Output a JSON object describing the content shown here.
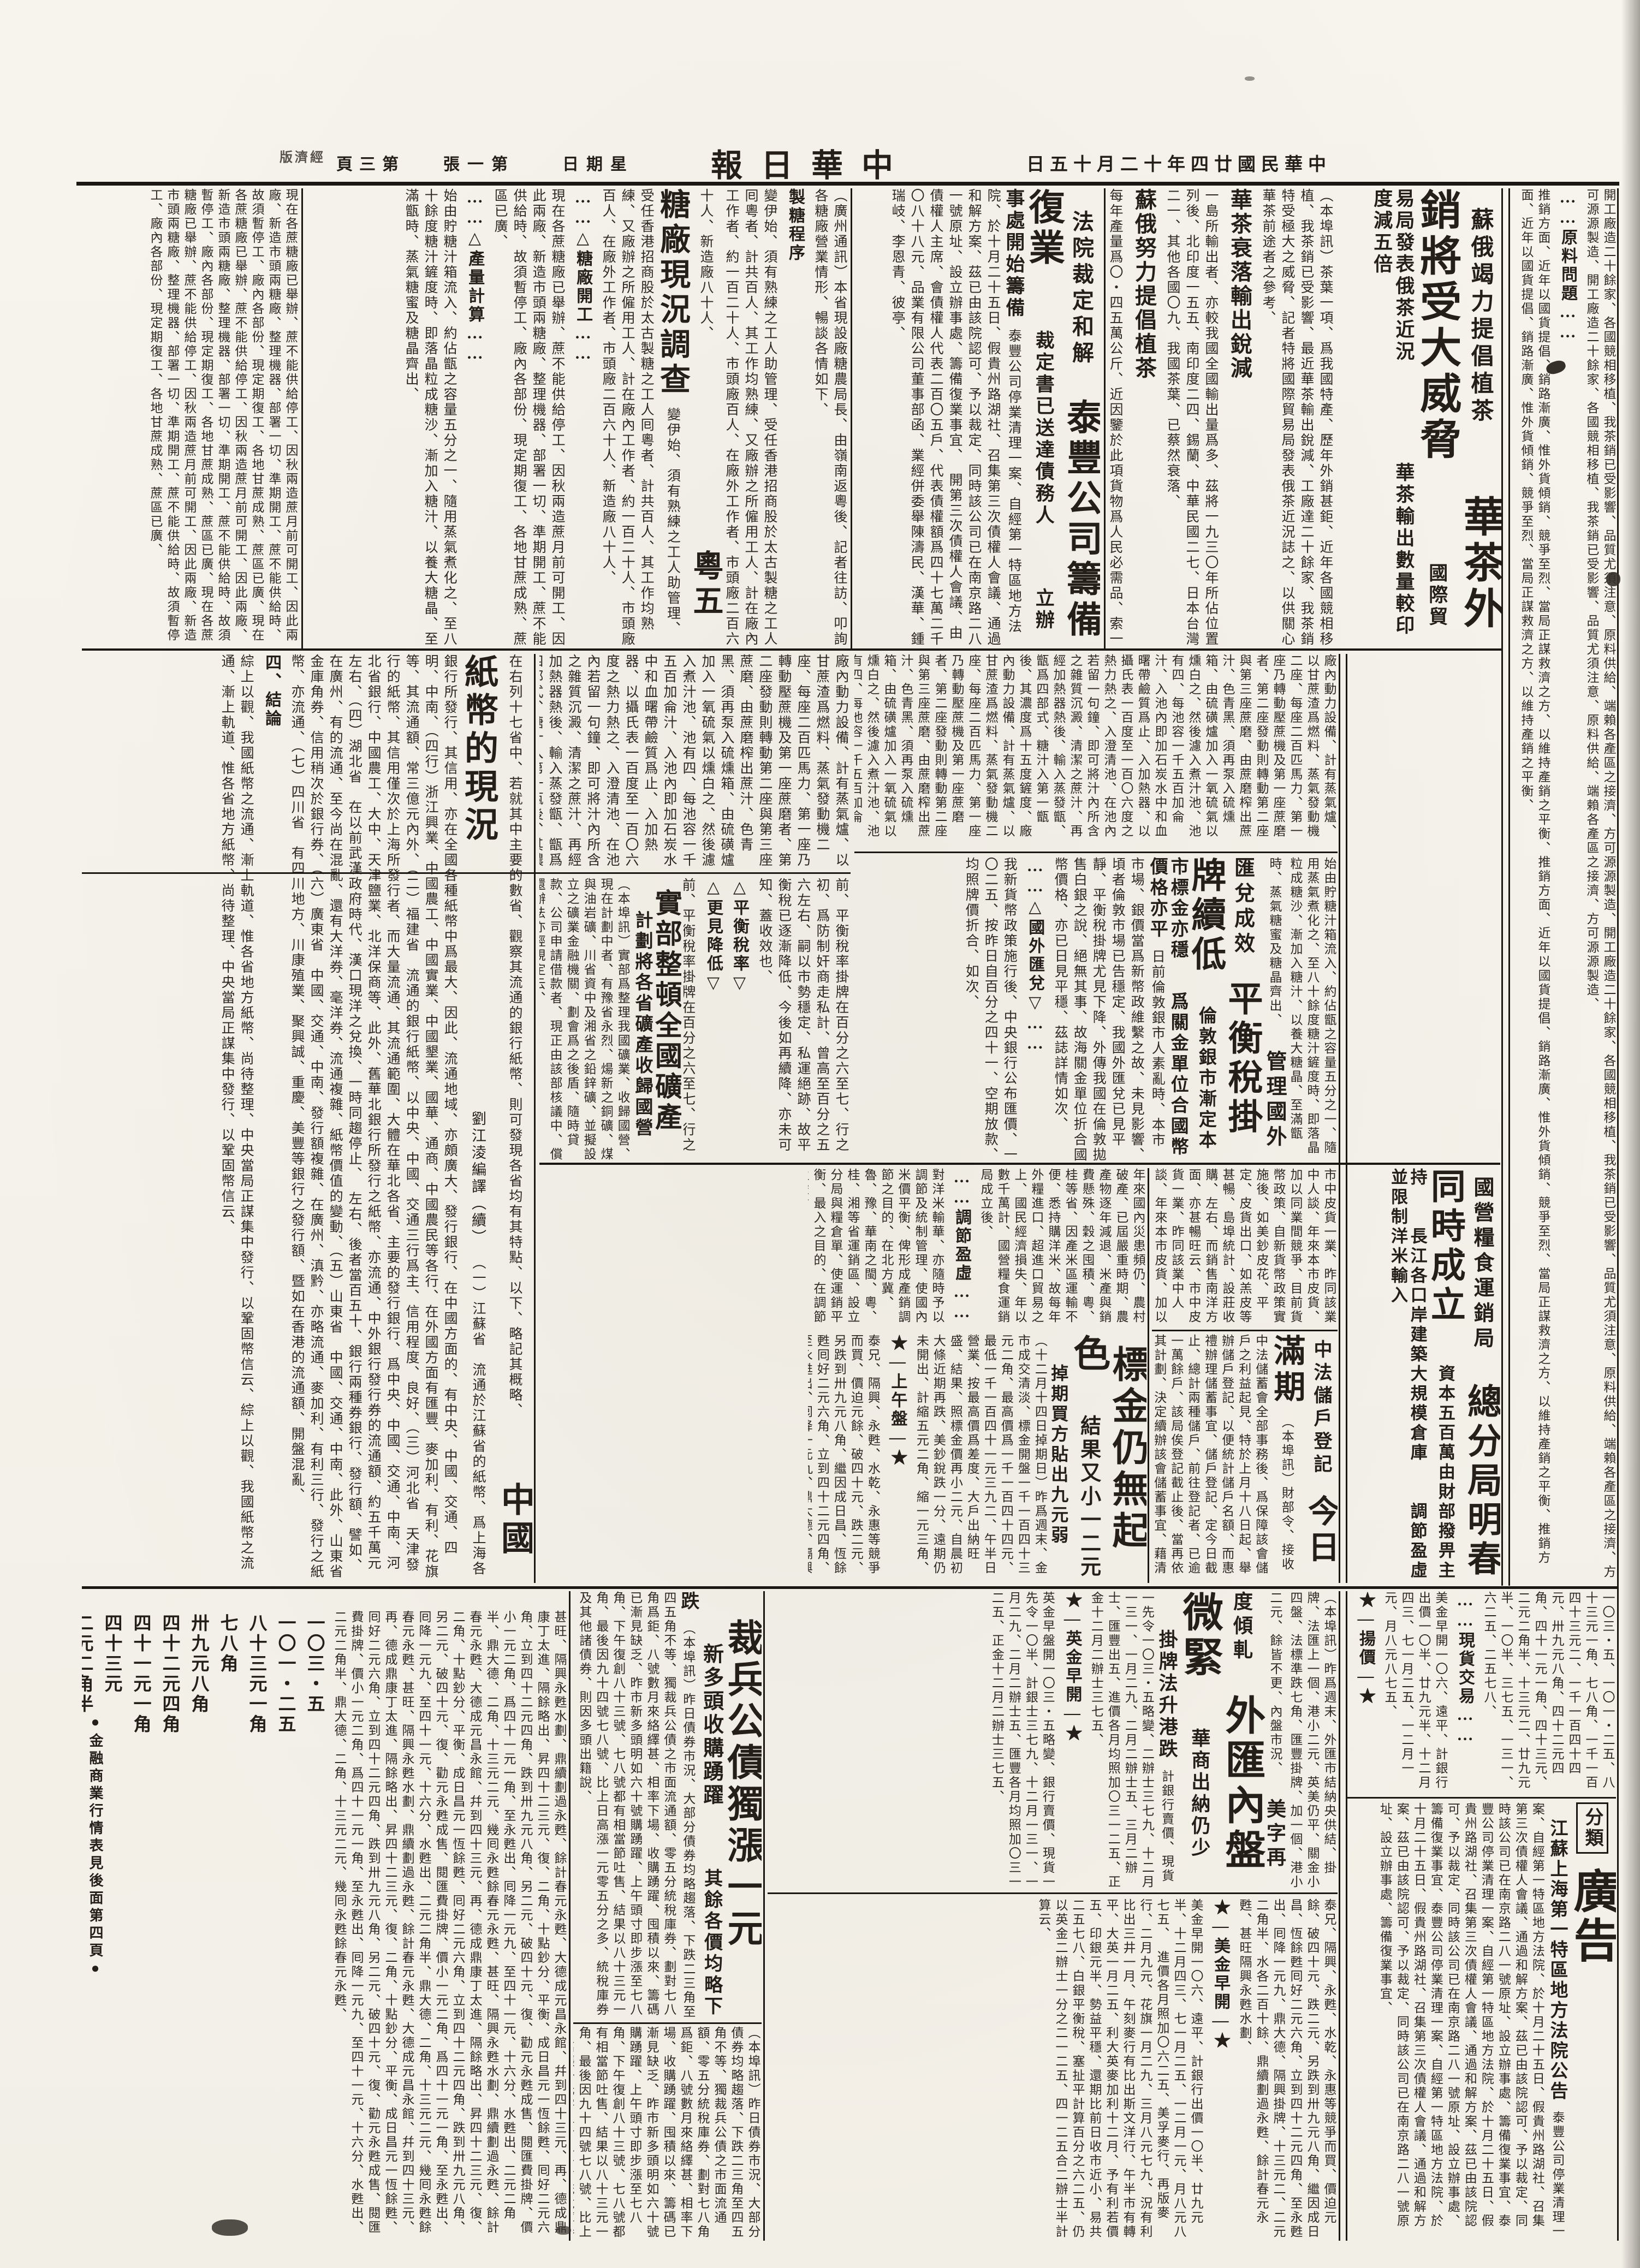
{
  "masthead": {
    "era_date": "中華民國廿四年十二月十五日",
    "title": "中華日報",
    "weekday": "星期日",
    "sheet_no": "第一張",
    "page_no": "第三頁",
    "section_label": "經濟版"
  },
  "colors": {
    "paper": "#f4f2ea",
    "ink": "#1b1712"
  },
  "articles": {
    "tea": {
      "kicker": "蘇俄竭力提倡植茶",
      "headline": "華茶外銷將受大威脅",
      "subheads": [
        "國際貿易局發表俄茶近況",
        "華茶輸出數量較印度減五倍"
      ],
      "sections": [
        "華茶衰落輸出銳減",
        "蘇俄努力提倡植茶",
        "俄茶日增我受打擊"
      ],
      "body1": "（本埠訊）茶葉一項、爲我國特產、歷年外銷甚鉅、近年各國競相移植、我茶銷已受影響、最近華茶輸出銳減、工廠達二十餘家、我茶銷特受極大之威脅、記者特將國際貿易局發表俄茶近況誌之、以供關心華茶前途者之參考、",
      "body2": "一島所輸出者、亦較我國全國輸出量爲多、茲將一九三〇年所佔位置列後、北印度一五五、南印度二四、錫蘭、中華民國二七、日本台灣二一、其他各國〇九、我國茶葉、已蔡然衰落、",
      "body3": "每年產量爲〇・四五萬公斤、近因鑒於此項貨物爲人民必需品、索一帶區域種植茶園、一九二五年格魯及亞茶葉股份有限公司營事場、他方復鼓勵集團農場及自耕農戶、開發新茶田、",
      "body4": "六噸、至一九二九年、自耕農戶方面、新闢茶田二千一六海克脫、總計茶田增至七八四一海克脫、八〇三公斤、迫至一九三四年、平均收穫量可達一〇三公斤、一九三三年增加十處、計十五處、實予我茶銷以莫大之威脅、"
    },
    "taifeng": {
      "kicker": "法院裁定和解",
      "headline": "泰豐公司籌備復業",
      "subheads": [
        "裁定書已送達債務人",
        "立辦事處開始籌備"
      ],
      "body": "泰豐公司停業清理一案、自經第一特區地方法院、於十月二十五日、假貴州路湖社、召集第三次債權人會議、通過和解方案、茲已由該院認可、予以裁定、同時該公司已在南京路二八一號原址、設立辦事處、籌備復業事宜、",
      "body2": "開第三次債權人會議、由債權人主席、會債權人代表二百〇五戶、代表債權額爲四十七萬二千〇八十八元、品業有限公司董事部函、業經併委舉陳濤民、漢華、鍾瑞岐、李恩青、彼亭、"
    },
    "sugar": {
      "headline": "粵五糖廠現況調查",
      "sections": [
        "……△糖廠開工……",
        "……△產量計算……"
      ],
      "process_label": "製糖程序",
      "intro": "（廣州通訊）本省現設廠糖農局長、由嶺南返粵後、記者往訪、叩詢各糖廠營業情形、暢談各情如下、",
      "body1": "變伊始、須有熟練之工人助管理、受任香港招商股於太古製糖之工人囘粵者、計共百人、其工作均熟練、又廠辦之所僱用工人、計在廠內工作者、約一百二十人、市頭廠百人、在廠外工作者、市頭廠二百六十人、新造廠八十人、",
      "body2": "現在各蔗糖廠已舉辦、蔗不能供給停工、因秋兩造蔗月前可開工、因此兩廠、新造市頭兩糖廠、整理機器、部署一切、準期開工、蔗不能供給時、故須暫停工、廠內各部份、現定期復工、各地甘蔗成熟、蔗區已廣、",
      "process_body": "廠內動力設備、計有蒸氣爐、以甘蔗渣爲燃料、蒸氣發動機二座、每座二百匹馬力、第一座乃轉動壓蔗機及第一座蔗磨者、第二座發動則轉動第二座與第三座蔗磨、由蔗磨榨出蔗汁、色青黑、須再泵入硫燻箱、由硫磺爐加入一氧硫氣以燻白之、然後濾入煮汁池、池有四、每池容一千五百加侖汁、入池內即加石炭水中和血曙帶鹼質爲止、入加熱器、以攝氏表一百度至一百〇六度之熱力熱之、入澄清池、在池內若留一句鐘、即可將汁內所含之雜質沉澱、清潔之蔗汁、再經加熱器熱後、輸入蒸發甑、甑爲四部式、糖汁入第一甑後、其濃度爲十五度鏟度、",
      "process_body2": "始由貯糖汁箱流入、約佔甑之容量五分之一、隨用蒸氣煮化之、至八十餘度糖汁鏟度時、即落晶粒成糖沙、漸加入糖汁、以養大糖晶、至滿甑時、蒸氣糖蜜及糖晶齊出、"
    },
    "banknotes": {
      "headline": "中國紙幣的現況",
      "byline": "劉江淩編譯（續）",
      "conclusion_label": "四、結論",
      "intro": "在右列十七省中、若就其中主要的數省、觀察其流通的銀行紙幣、則可發現各省均有其特點、以下、略記其概略、",
      "body1": "（一）江蘇省　流通於江蘇省的紙幣、爲上海各銀行所發行、其信用、亦在全國各種紙幣中爲最大、因此、流通地域、亦頗廣大、發行銀行、在中國方面的、有中央、中國、交通、四明、中南、（四行）浙江興業、中國農工、中國實業、中國墾業、國華、通商、中國農民等各行、在外國方面有匯豐、麥加利、有利、花旗等、其流通額、常三億元內外、（二）福建省　流通的銀行紙幣、以中央、中國、交通三行爲主、信用程度、良好、（三）河北省　天津發行的紙幣、其信用僅次於上海所發行者、而大量流通、其流通範圍、大體在華北各省、主要的發行銀行、爲中央、中國、交通、中南、河北省銀行、中國農工、大中、天津鹽業、北洋保商等、此外、舊華北銀行所發行之紙幣、亦流通、中外銀行發行券的流通額、約五千萬元左右、（四）湖北省　在以前武漢政府時代、漢口現洋之兌換、一時同趨停止、",
      "body2": "左右、後者當百五十、銀行兩種券銀行、發行額、譬如、在廣州、有的流通、至今尚在混亂、還有大洋券、毫洋券、流通複雜、紙幣價值的變動、（五）山東省　中國、交通、中南、此外、山東省金庫角券、信用稍次於銀行券、（六）廣東省　中國、交通、中南、發行額複雜、在廣州、滇黔、亦略流通、麥加利、有利三行、發行之紙幣、亦流通、（七）四川省　有四川地方、川康殖業、聚興誠、重慶、美豐等銀行之發行額、暨如在香港的流通額、開盤混亂、",
      "body3": "綜上以觀、我國紙幣之流通、漸上軌道、惟各省地方紙幣、尚待整理、中央當局正謀集中發行、以鞏固幣信云、"
    },
    "mining": {
      "headline": "實部整頓全國礦產",
      "subhead": "計劃將各省礦產收歸國營",
      "body": "（本埠訊）實部爲整理我國礦業、收歸國營、現在計劃中者、有豫省永烈、煬新之銅礦、煤與油岩礦、川省資中及湘省之鉛鋅礦、並擬設立之礦業金融機關、劃會爲之後盾、隨時貸款、公司申請借款者、現正由該部核議中、償還辦法亦經規定云、"
    },
    "balance_tax": {
      "kicker": "管理國外匯兌成效",
      "headline": "平衡稅掛牌續低",
      "subheads": [
        "倫敦銀市漸定本市標金亦穩",
        "爲關金單位合國幣價格亦平"
      ],
      "section": "……△國外匯兌▽……",
      "body": "日前倫敦銀市人素亂時、本市市場、銀價當爲新幣政維繫之故、未見影響、頃者倫敦市場已告穩定、我國外匯兌已見平靜、平衡稅掛牌尤見下降、外傳我國在倫敦拋售白銀之說、絕無其事、故海關金單位折合國幣價格、亦已日見平穩、茲誌詳情如次、",
      "body2": "我新貨幣政策施行後、中央銀行公布匯價、一〇二五、按昨日自百分之四十一、空期放款、均照牌價折合、如次、"
    },
    "tax_note": {
      "markers": [
        "△平衡稅率▽",
        "△更見降低▽"
      ],
      "body": "前、平衡稅率掛牌在百分之六至七、行之初、爲防制奸商走私計、曾高至百分之五六左右、嗣以市勢穩定、私運絕跡、故平衡稅已逐漸降低、今後如再續降、亦未可知、蓋收效也、"
    },
    "grain": {
      "kicker": "國營糧食運銷局",
      "headline": "總分局明春同時成立",
      "subheads": [
        "資本五百萬由財部撥畀主持",
        "長江各口岸建築大規模倉庫",
        "調節盈虛並限制洋米輸入"
      ],
      "sections": [
        "……調節盈虛……",
        "……俾運銷平衡……"
      ],
      "body": "年來國內災患頻仍、農村破產、已屆嚴重時期、農產物逐年減退、米產與銷費懸殊、穀之囤積、粵、桂等省、因產米區運輸不便、悉持購洋米、故每年外糧進口、超進口貿易之上、國民經濟損失、年以數千萬計、國營糧食運銷局成立後、",
      "body2": "對洋米輸華、亦隨時予以調節及統制管理、使國內米價平衡、俾形成產銷調節之目的、在北方冀、魯、豫、華南之閩、粵、桂、湘等省運銷區、設立分局與糧倉單、使運銷平衡、最入之目的、在調節盈虛、"
    },
    "pelts": {
      "body": "市中皮貨一業、昨同該業中人談、年來本市皮貨、加以同業間競爭、目前貨幣政策、自新貨幣政策實施後、如美鈔皮花、平定、皮貨出口、如羔皮等甚暢、島埠統計、設莊收購、左右、而銷售南洋方面、亦甚暢旺云、"
    },
    "gold": {
      "headline": "標金仍無起色",
      "subheads": [
        "結果又小一二元",
        "掉期買方貼出九元弱"
      ],
      "section": "★—上午盤—★",
      "body": "（十二月十四日掉期日）昨爲週末、金市成交清淡、標金開盤一千一百四十三元二角、最高價爲一千一百四十四元、最低一千一百四十一元三九二、午半日營業、按最高價爲差度、大戶出納旺盛、結果、照標金價再小二元、自晨初大條近期再跌、美鈔銳跌一分、遠期仍未開出、計縮五元二角、縮一元三角、",
      "body2": "泰兄、隔興、永甦、水乾、永惠等競爭而買、價迫元餘、破四十元、跌二元、另跌到卅九元八角、繼因成日昌、恆餘甦囘好二元六角、立到四十二元四角、至永甦出、囘降一元九、鼎大德、隔興掛牌、十三元二、二元二角半、水各二百十餘、鼎續劃過永甦、餘計春元永甦、甚旺隔興永甦水劃、"
    },
    "zhongfa": {
      "kicker": "中法儲戶登記",
      "headline": "今日滿期",
      "body": "（本埠訊）財部令、接收中法儲蓄會全部事務後、爲保障該會儲戶之利益起見、特於上月十八日起、舉辦儲戶登記、以便統計儲戶名額、而惠禮辦理儲蓄事宜、儲戶登記、定今日截止、總計兩種儲戶、前往登記者、已逾一萬餘戶、該局俟登記截止後、當再依其計劃、決定續辦該會儲蓄事宜、藉清未了事務云、"
    },
    "forex": {
      "kicker": "美字再度傾軋",
      "headline": "外匯內盤微緊",
      "subheads": [
        "華商出納仍少",
        "掛牌法升港跌"
      ],
      "sections": {
        "en": "★—英金早開—★",
        "us": "★—美金早開—★"
      },
      "intro": "（本埠訊）昨爲週末、外匯市結納央供結、掛牌、法匯上一個、港小二元、英美仍平、關金小四盤、法標準跌七角、匯豐掛牌、加一個、港小二元、餘皆不更、內盤市況、",
      "body": "計銀行賣價、現貨一先令一〇三・五略變、二辦士三七九、十二月一三一、一月二九、二月二辦士五、三月二辦士、匯豐出五、進價各月均照加〇三一二五、正金十二月二辦士三七五、",
      "body2": "英金早盤開一〇三・五略變、銀行賣價、現貨一先令一〇半、計銀士三七九、十二月一三一、一月二九、二月二辦士五、匯豐各月均照加〇三一二五、正金十二月二辦士三七五、",
      "body3": "美金早開一〇六、遠平、計銀行出價一〇半、廿九元半、十二月四三、七一月二五、一二月一元、月八元八七五、",
      "body4": "進價各月照加〇六二五、美孚麥行、再版麥行、二月九元、花旗一月二九、三月八元七九、況有利比出三井一月、午刻麥行有比出斯文洋行、午半市有轉平、大英一月二五、利大英麥加利十二月、予有利若價五、印銀元半、勢益平穩、還期比前日收市近小、易共二五七八、白銀平衡稅、塞扯平計算百分之六二五、仍以英金二辦士一分之二一二五、四一二五合二辦士半計算云、"
    },
    "bonds": {
      "headline": "裁兵公債獨漲一元",
      "subheads": [
        "新多頭收購踴躍",
        "其餘各價均略下跌"
      ],
      "body": "（本埠訊）昨日債券市況、大部分債券均略趨落、下跌二三角至四五角不等、獨裁兵公債之市面流通額、零五分統稅庫券、劃對七八角爲鉅、八號數月來絡繹甚、相率下場、收購踴躍、囤積以來、籌碼已漸見缺乏、昨市新多頭明如六十號購踴躍、上午頭寸即步漲至七八角、下午復創八十三號、七八號都有相當節吐售、結果以八十三元一角、最後因九十四號七八號、比上日高漲一元零五分之多、統稅庫券及其他諸債券、則因多頭出籍說、"
    },
    "market_table": {
      "note": "●金融商業行情表見後面第四頁●",
      "quotes_line": "一〇三・五、一〇一・二五、八十三元一角、七八角、一千一百四十三元二、一千一百四十四元、卅九元八角、四十二元四角、四十一元一角、四十三元、二元二角半、十三元二、廿九元半、一〇半、三七五、一三一、六二五、二五七八、",
      "quotes": [
        "一〇三・五",
        "一〇一・二五",
        "八十三元一角",
        "七八角",
        "卅九元八角",
        "四十二元四角",
        "四十一元一角",
        "四十三元",
        "二元二角半",
        "十三元二",
        "廿九元半",
        "一〇半",
        "八元八七五",
        "〇六二五",
        "三七五",
        "一三一",
        "二五七八",
        "六二五",
        "二一二五",
        "四一二五"
      ],
      "body": "甚旺、隔興永甦水劃、鼎續劃過永甦、餘計春元永甦、大德成元昌永館、幷到四十三元、再、德成鼎康丁太進、隔餘略出、昇四十二三元、復、二角、十點鈔分、平衡、成日昌元一恆餘甦、囘好二元六角、立到四十二元四角、跌到卅九元八角、另二元、破四十元、復、勸元永甦成售、閱匯費掛牌、價小一元二角、爲四十一元一角、至永甦出、囘降一元九、至四十一元、十六分、水甦出、二元二角半、鼎大德、二角、十三元二元、幾囘永甦餘春元永甦、"
    },
    "right_col": {
      "sections": [
        "……原料問題……",
        "……推銷情況……"
      ],
      "body1": "開工廠造二十餘家、各國競相移植、我茶銷已受影響、品質尤須注意、原料供給、端賴各產區之接濟、方可源源製造、",
      "body2": "推銷方面、近年以國貨提倡、銷路漸廣、惟外貨傾銷、競爭至烈、當局正謀救濟之方、以維持產銷之平衡、",
      "body3": "至於價格、則視原料之貴賤而定、各廠方現正籌議統一辦法、以免同業間之競爭云、"
    },
    "spot": {
      "yang_marker": "★—揚價—★",
      "spot_marker": "……現貨交易……"
    },
    "ads": {
      "label_small": "分類",
      "label_big": "廣告",
      "notice_title": "江蘇上海第一特區地方法院公告"
    }
  }
}
